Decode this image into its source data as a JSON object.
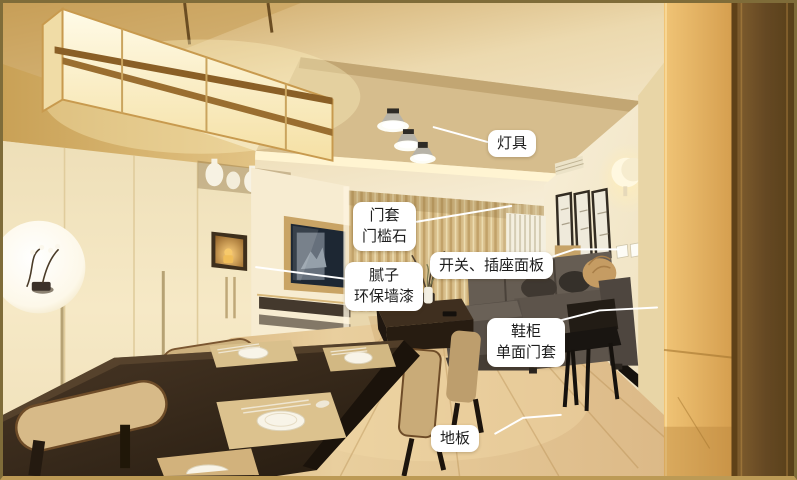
{
  "annotations": {
    "items": [
      {
        "name": "lighting",
        "text": "灯具"
      },
      {
        "name": "door-casing-threshold-stone",
        "text": "门套\n门槛石"
      },
      {
        "name": "switch-socket-panel",
        "text": "开关、插座面板"
      },
      {
        "name": "putty-eco-wall-paint",
        "text": "腻子\n环保墙漆"
      },
      {
        "name": "shoe-cabinet-single-casing",
        "text": "鞋柜\n单面门套"
      },
      {
        "name": "floor",
        "text": "地板"
      }
    ]
  },
  "palette": {
    "label_bg": "#ffffff",
    "label_text": "#1e1e1e",
    "leader_line": "#ffffff",
    "photo_frame_border": "#7f6c39",
    "wall_cream": "#f4e7c6",
    "wood_light": "#e3b365",
    "wood_dark": "#6e4e26",
    "sofa_gray": "#5b5249",
    "table_dark": "#2e2216",
    "floor_wood": "#dcb987"
  },
  "scene": {
    "objects": [
      "pendant-lamp",
      "ceiling-spotlights",
      "wardrobe",
      "round-niche-orchid",
      "display-vases",
      "tv",
      "tv-console",
      "curtain",
      "radiator",
      "wall-lamp",
      "picture-frames",
      "switch-socket-panels",
      "sofa",
      "coffee-table",
      "dining-table",
      "dining-chairs",
      "black-chair",
      "shoe-cabinet-panel",
      "door-casing-panel",
      "wood-floor"
    ]
  }
}
